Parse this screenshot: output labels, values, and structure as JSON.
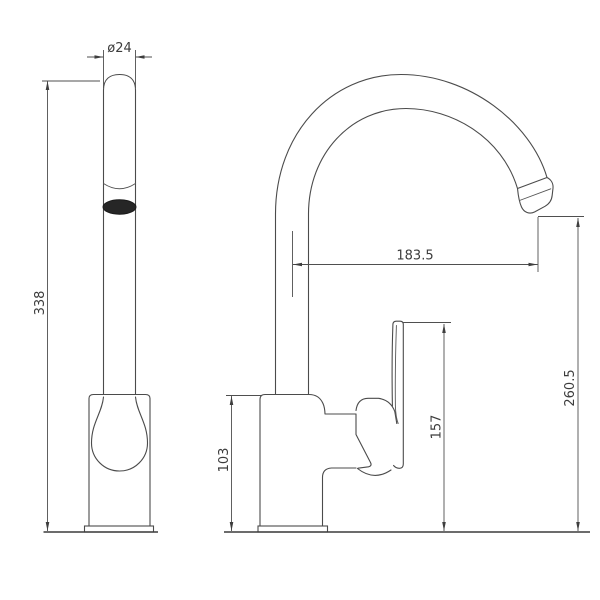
{
  "dimensions": {
    "spout_diameter": "ø24",
    "overall_height": "338",
    "spout_reach": "183.5",
    "outlet_height": "260.5",
    "handle_height": "157",
    "body_height": "103"
  },
  "colors": {
    "line": "#4b4b4b",
    "dimension_line": "#4f4f4f",
    "text": "#3c3c3c",
    "outlet_fill": "#262626",
    "background": "#ffffff"
  }
}
